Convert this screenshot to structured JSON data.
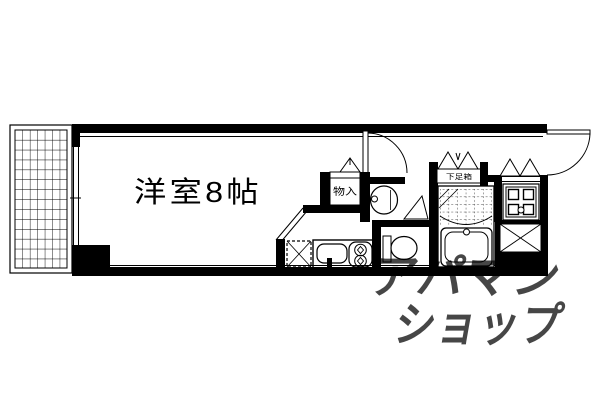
{
  "labels": {
    "room": "洋室8帖",
    "closet": "物入",
    "shoe_cabinet": "下足箱"
  },
  "watermark": {
    "line1": "アパマン",
    "line2": "ショップ",
    "color": "#bfc4c2"
  },
  "colors": {
    "line": "#000000",
    "background": "#ffffff"
  },
  "icons": {
    "balcony_grid": "balcony-tile-grid",
    "sliding_window": "sliding-window",
    "room_door": "hinged-door-arc",
    "entrance_door": "hinged-door-arc",
    "closet_door": "folding-door-triangle",
    "shoe_cabinet_door": "bifold-door-triangles",
    "laundry_door": "bifold-door-triangles",
    "washroom_door": "folding-door-triangle",
    "kitchen_sink": "sink-basin",
    "stove": "two-burner-stove",
    "refrigerator_space": "dashed-x-box",
    "wash_basin": "oval-basin",
    "toilet": "toilet-bowl-tank",
    "bath_tub": "bathtub",
    "bath_tiles": "dashed-tile-grid",
    "washing_machine_pan": "corner-squares-pan",
    "pipe_space": "x-cross-box"
  }
}
